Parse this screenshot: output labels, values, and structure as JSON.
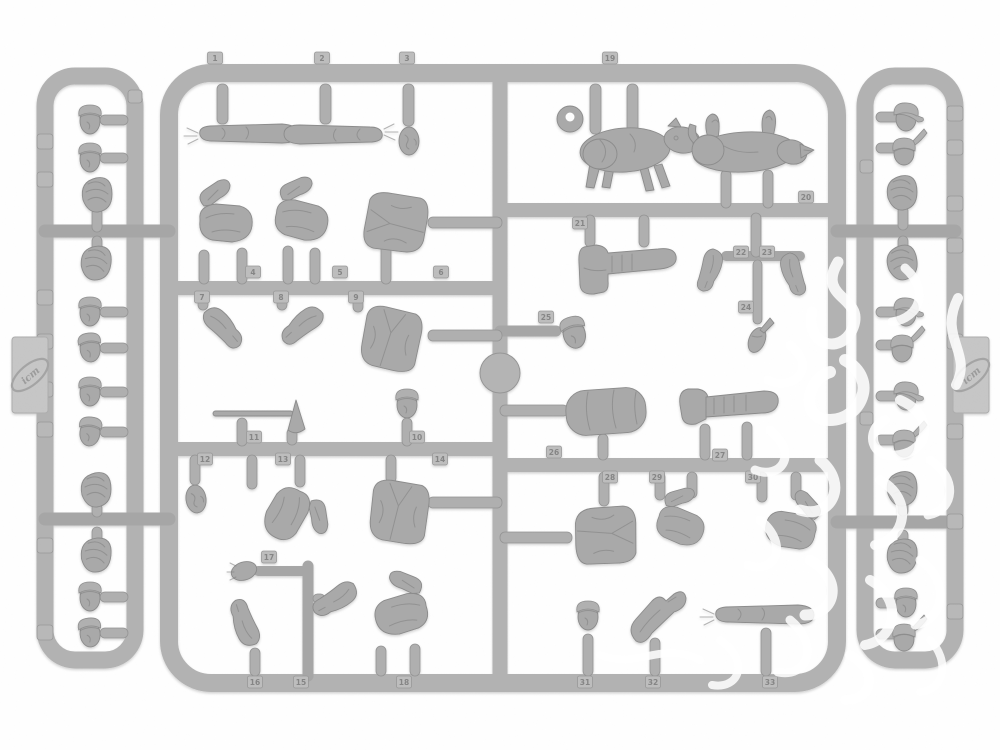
{
  "photo": {
    "subject": "Unpainted light-grey plastic model kit sprue with figure parts (heads, caps, spiked helmets, arms, legs, torsos, two dogs, tools)",
    "background": "#ffffff",
    "plastic_color_name": "light grey"
  },
  "brand": {
    "logo_text": "icm"
  },
  "colors": {
    "rail": "#b2b2b2",
    "part": "#a9a9a9",
    "part_shadow": "#8b8b8b",
    "tag_plate": "#bdbdbd",
    "tag_number": "#858585",
    "logo_tab": "#c6c6c6",
    "watermark": "#ffffff"
  },
  "part_number_tags": [
    {
      "label": "1",
      "x": 215,
      "y": 58
    },
    {
      "label": "2",
      "x": 322,
      "y": 58
    },
    {
      "label": "3",
      "x": 407,
      "y": 58
    },
    {
      "label": "4",
      "x": 253,
      "y": 272
    },
    {
      "label": "5",
      "x": 340,
      "y": 272
    },
    {
      "label": "6",
      "x": 441,
      "y": 272
    },
    {
      "label": "7",
      "x": 202,
      "y": 297
    },
    {
      "label": "8",
      "x": 281,
      "y": 297
    },
    {
      "label": "9",
      "x": 356,
      "y": 297
    },
    {
      "label": "10",
      "x": 417,
      "y": 437
    },
    {
      "label": "11",
      "x": 254,
      "y": 437
    },
    {
      "label": "12",
      "x": 205,
      "y": 459
    },
    {
      "label": "13",
      "x": 283,
      "y": 459
    },
    {
      "label": "14",
      "x": 440,
      "y": 459
    },
    {
      "label": "15",
      "x": 301,
      "y": 682
    },
    {
      "label": "16",
      "x": 255,
      "y": 682
    },
    {
      "label": "17",
      "x": 269,
      "y": 557
    },
    {
      "label": "18",
      "x": 404,
      "y": 682
    },
    {
      "label": "19",
      "x": 610,
      "y": 58
    },
    {
      "label": "20",
      "x": 806,
      "y": 197
    },
    {
      "label": "21",
      "x": 580,
      "y": 223
    },
    {
      "label": "22",
      "x": 741,
      "y": 252
    },
    {
      "label": "23",
      "x": 767,
      "y": 252
    },
    {
      "label": "24",
      "x": 746,
      "y": 307
    },
    {
      "label": "25",
      "x": 546,
      "y": 317
    },
    {
      "label": "26",
      "x": 554,
      "y": 452
    },
    {
      "label": "27",
      "x": 720,
      "y": 455
    },
    {
      "label": "28",
      "x": 610,
      "y": 477
    },
    {
      "label": "29",
      "x": 657,
      "y": 477
    },
    {
      "label": "30",
      "x": 753,
      "y": 477
    },
    {
      "label": "31",
      "x": 585,
      "y": 682
    },
    {
      "label": "32",
      "x": 653,
      "y": 682
    },
    {
      "label": "33",
      "x": 770,
      "y": 682
    }
  ],
  "inventory": {
    "main_frame_parts": [
      "pointing arm",
      "straight arm",
      "bare head",
      "bent legs",
      "bent legs",
      "greatcoat torso",
      "hanging arm",
      "hanging arm",
      "greatcoat torso",
      "helmeted head",
      "pick tool",
      "bare head",
      "bent legs",
      "greatcoat torso",
      "hand",
      "bent arm",
      "open-hand arm",
      "kneeling legs",
      "standing dog",
      "lying dog",
      "booted leg",
      "bent arm",
      "bent arm",
      "fist",
      "capped head",
      "bedroll",
      "puttee leg",
      "greatcoat torso",
      "kneeling legs",
      "squatting legs",
      "capped head",
      "raised arms",
      "pointing arm",
      "ejector disc"
    ],
    "left_strip_parts": [
      "capped head",
      "capped head",
      "forage cap",
      "forage cap",
      "capped head",
      "capped head",
      "capped head",
      "capped head",
      "forage cap",
      "forage cap",
      "capped head",
      "capped head"
    ],
    "right_strip_parts": [
      "peaked cap head",
      "spiked helmet head",
      "forage cap",
      "forage cap",
      "peaked cap head",
      "spiked helmet head",
      "peaked cap head",
      "spiked helmet head",
      "forage cap",
      "forage cap",
      "capped head",
      "spiked helmet head"
    ]
  }
}
